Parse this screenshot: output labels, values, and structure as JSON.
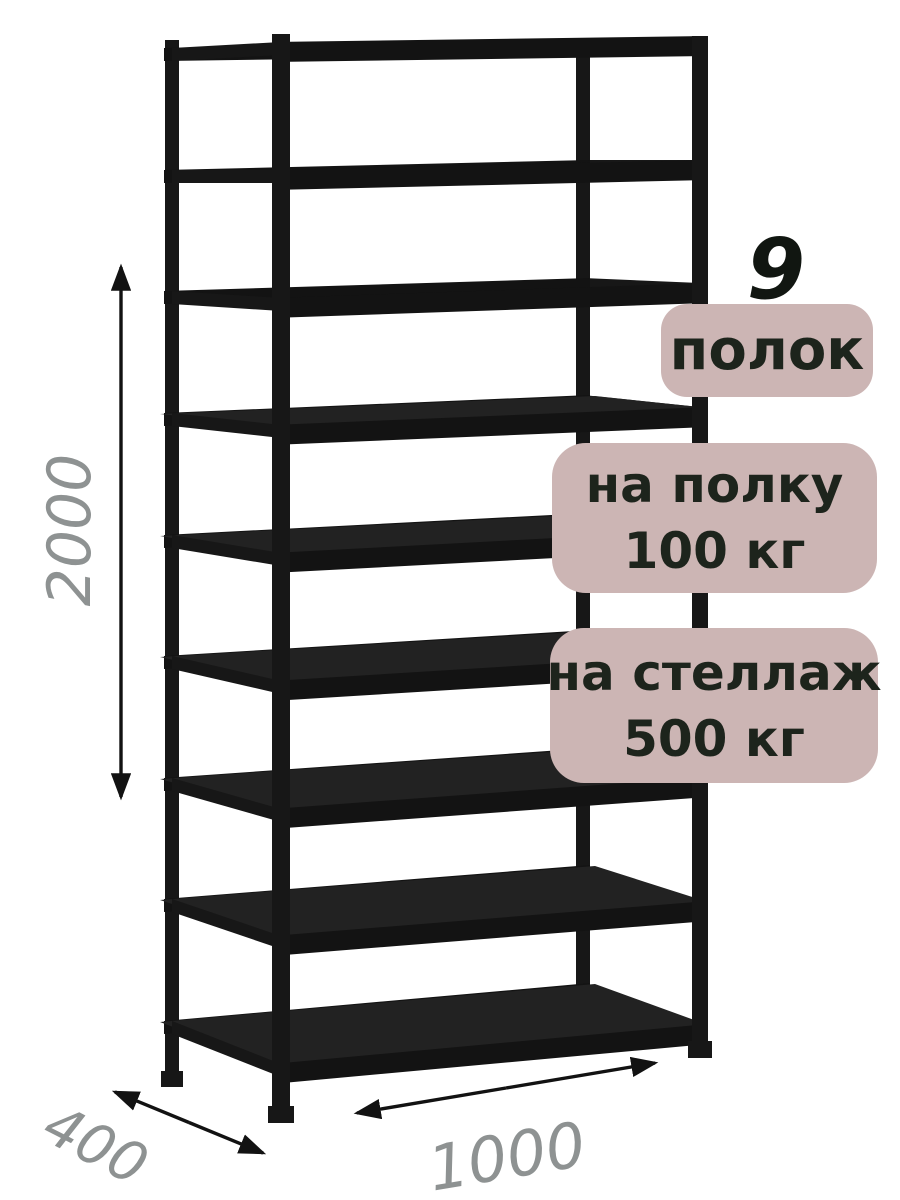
{
  "product": {
    "type_label": "metal-shelving-rack",
    "shelf_count": 9,
    "count_number": "9",
    "count_caption": "полок",
    "shelf_load_line1": "на полку",
    "shelf_load_line2": "100 кг",
    "rack_load_line1": "на стеллаж",
    "rack_load_line2": "500 кг"
  },
  "dimensions": {
    "height": "2000",
    "depth": "400",
    "width": "1000"
  },
  "colors": {
    "background": "#ffffff",
    "badge_bg": "#ccb5b4",
    "badge_text": "#1d241c",
    "count_text": "#111611",
    "dimension_text": "#8e9292",
    "arrow": "#121212",
    "rack_dark": "#171717",
    "rack_beam": "#131313",
    "rack_surface": "#222222"
  }
}
